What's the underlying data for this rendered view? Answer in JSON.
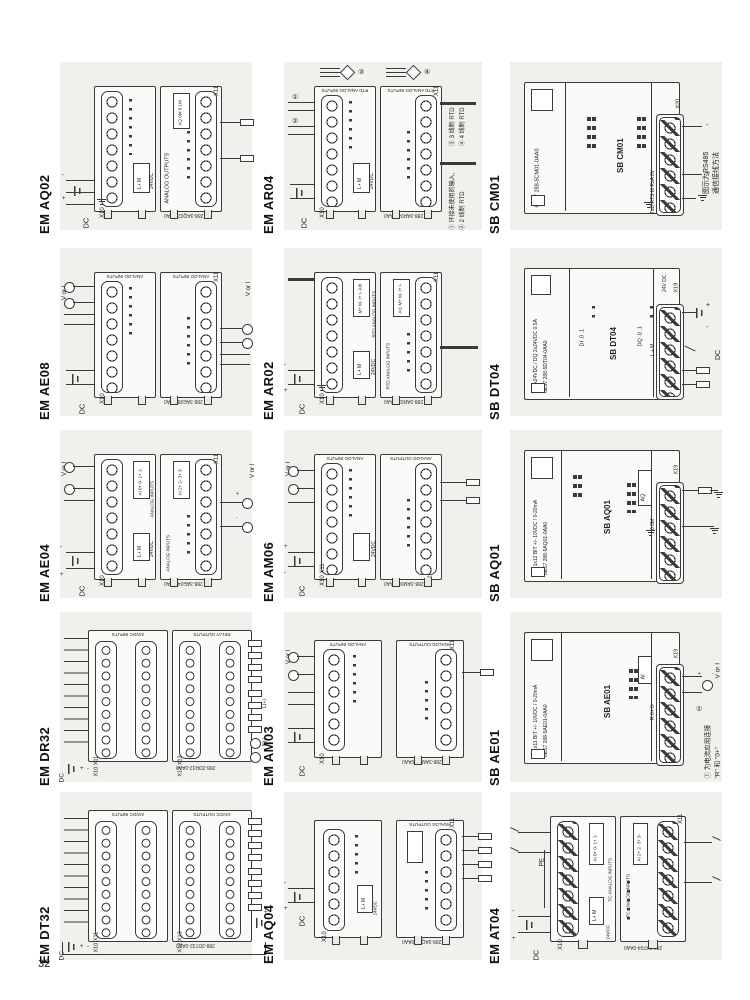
{
  "page": {
    "number": "32"
  },
  "colors": {
    "panel_bg": "#f1f0ec",
    "line": "#3a3a3a",
    "page_bg": "#ffffff"
  },
  "sym": {
    "plus": "+",
    "minus": "-",
    "dc": "DC",
    "vori": "V or I",
    "pe": "PE",
    "lplus": "L(+)",
    "nminus": "N(-)",
    "ac": "~",
    "m1": "①",
    "m2": "②",
    "m3": "③",
    "m4": "④"
  },
  "cells": [
    {
      "label": "EM AQ02",
      "conn_l": "X10",
      "conn_r": "X11",
      "cap_r": "ANALOG OUTPUTS",
      "pins_r": "AQ 0M 0 1M",
      "pwr": "24VDC",
      "pins_pwr": "L+ M",
      "part": "288-3AQ02-0AA0"
    },
    {
      "label": "EM AR04",
      "cap": "RTD ANALOG INPUTS",
      "conn_l": "X10",
      "conn_r": "X11",
      "pwr": "24VDC",
      "pins_pwr": "L+ M",
      "part": "288-3AR04-0AA0",
      "note1": "① 环接未使用的输入,",
      "note2": "② 2 线制 RTD",
      "note3": "③ 3 线制 RTD",
      "note4": "④ 4 线制 RTD"
    },
    {
      "label": "SB CM01",
      "name": "SB CM01",
      "part": "6ES7 288-5CM01-0AA0",
      "conn": "X20",
      "pins": "TxD RTS M RxA 0V",
      "note1": "图示为RS485",
      "note2": "通信接线方法"
    },
    {
      "label": "EM AE08",
      "cap": "ANALOG INPUTS",
      "conn_l": "X10",
      "conn_r": "X11",
      "part": "288-3AE08-0AA0"
    },
    {
      "label": "EM AR02",
      "cap": "RTD ANALOG INPUTS",
      "pins_l": "M+ M- I+ I-  AI0",
      "pins_r": "AI1  M+ M- I+ I-",
      "conn_l": "X10",
      "conn_r": "X11",
      "pwr": "24VDC",
      "pins_pwr": "L+ M",
      "part": "288-3AR02-0AA0"
    },
    {
      "label": "SB DT04",
      "name": "SB DT04",
      "spec": "DI 2x24VDC / DQ 2x24VDC 0.5A",
      "part": "6ES7 288-5DT04-0AA0",
      "di": "DI  .0 .1",
      "dq": "DQ  .0 .1",
      "pins": "L + M",
      "pwr": "24V DC",
      "conn": "X19"
    },
    {
      "label": "EM AE04",
      "cap": "ANALOG INPUTS",
      "pins_l": "AI  0+ 0- 1+ 1-",
      "pins_r": "AI  2+ 2- 3+ 3-",
      "conn_l": "X10",
      "conn_r": "X11",
      "pwr": "24VDC",
      "pins_pwr": "L+ M",
      "part": "288-3AE04-0AA0"
    },
    {
      "label": "EM AM06",
      "cap_l": "ANALOG INPUTS",
      "cap_r": "ANALOG OUTPUTS",
      "conn_l": "X10  X11",
      "conn_r": "X12",
      "pwr": "24VDC",
      "part": "288-3AM06-0AA0"
    },
    {
      "label": "SB AQ01",
      "name": "SB AQ01",
      "spec": "AQ 1x12 BIT +/- 10VDC / 0-20mA",
      "part": "6ES7 288-5AQ01-0AA0",
      "aq": "AQ",
      "pins": "0  0M",
      "conn": "X19"
    },
    {
      "label": "EM DR32",
      "cap_l": "24VDC INPUTS",
      "cap_r": "RELAY OUTPUTS",
      "conn_l": "X10  X11",
      "conn_r": "X12  X13",
      "pwr": "24VDC",
      "part": "288-2DR32-0AA0"
    },
    {
      "label": "EM AM03",
      "cap_l": "ANALOG INPUTS",
      "cap_r": "ANALOG OUTPUTS",
      "conn_l": "X10",
      "conn_r": "X11",
      "part": "288-3AM03-0AA0"
    },
    {
      "label": "SB AE01",
      "name": "SB AE01",
      "spec": "AI 1x11 BIT +/- 10VDC / 0-20mA",
      "part": "6ES7 288-5AE01-0AA0",
      "ai": "AI",
      "pins": "R 0+ 0-",
      "conn": "X19",
      "note1": "① 为电流应用连接",
      "note2": "\"R\" 和 \"0+\""
    },
    {
      "label": "EM DT32",
      "cap_l": "24VDC INPUTS",
      "cap_r": "24VDC OUTPUTS",
      "conn_l": "X10  X11",
      "conn_r": "X12  X13",
      "pwr": "24VDC",
      "part": "288-2DT32-0AA0"
    },
    {
      "label": "EM AQ04",
      "cap_r": "ANALOG OUTPUTS",
      "conn_l": "X10",
      "conn_r": "X11",
      "pwr": "24VDC",
      "pins_pwr": "L+ M",
      "part": "288-3AQ04-0AA0"
    },
    {
      "label": "EM AT04",
      "cap": "TC ANALOG INPUTS",
      "pins_l": "AI  0+ 0- 1+ 1-",
      "pins_r": "AI  2+ 2- 3+ 3-",
      "conn_l": "X10",
      "conn_r": "X11",
      "pwr": "24VDC",
      "pins_pwr": "L+ M",
      "part": "288-3AT04-0AA0"
    }
  ]
}
